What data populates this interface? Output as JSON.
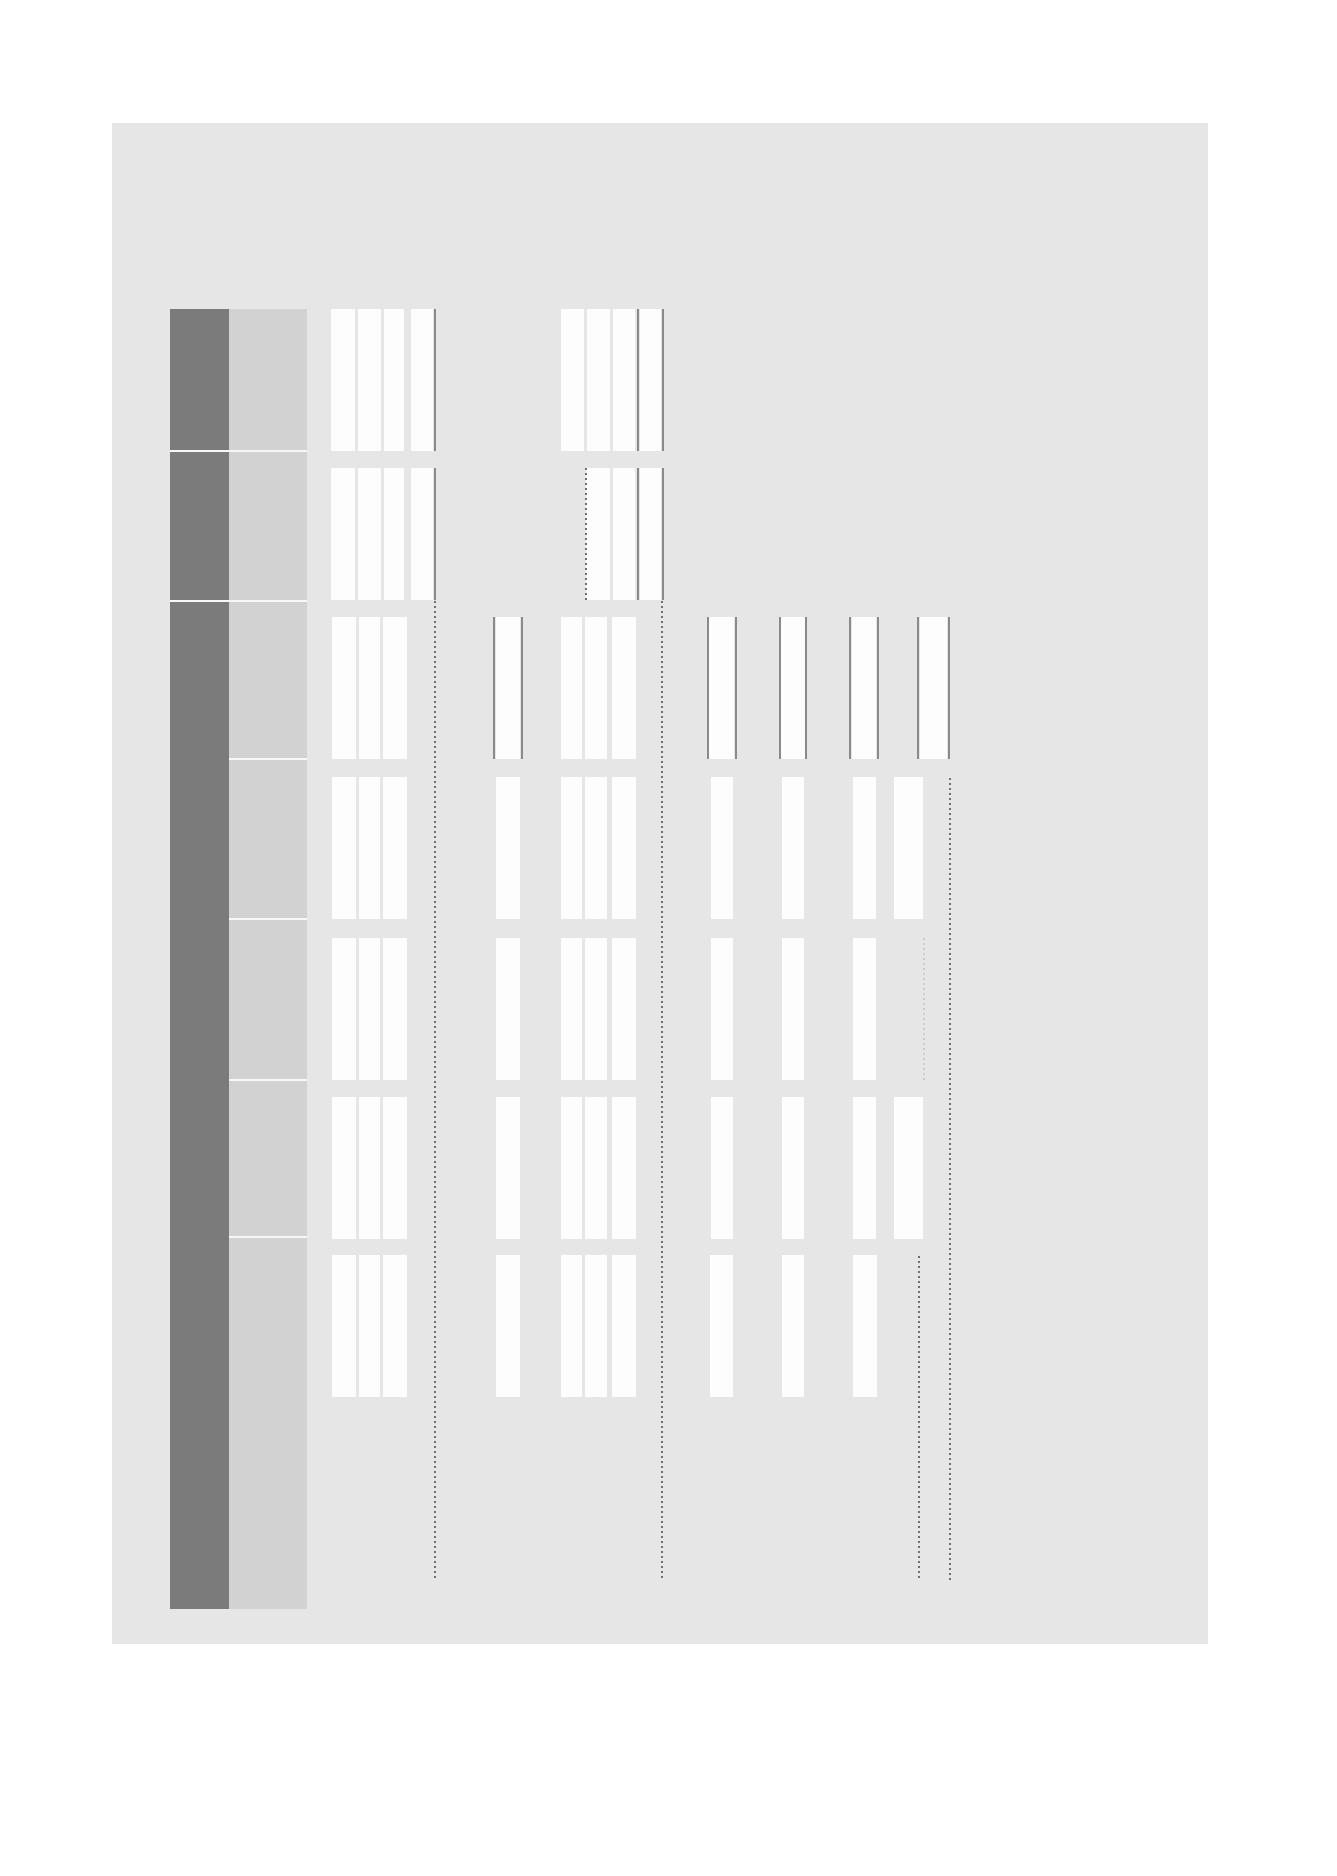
{
  "colors": {
    "canvas_bg": "#ffffff",
    "page_bg": "#e6e6e6",
    "header_dark": "#7b7b7b",
    "header_light": "#d2d2d2",
    "bar": "#fdfdfd",
    "border_line": "#8a8a8a",
    "dotted_dark": "#707070",
    "dotted_light": "#cccccc",
    "row_separator": "#f7f7f7"
  },
  "figure": {
    "canvas": {
      "w": 1337,
      "h": 1876
    },
    "page": {
      "x": 112,
      "y": 123,
      "w": 1096,
      "h": 1521
    },
    "header_columns": [
      {
        "id": "dark",
        "x": 170,
        "w": 59,
        "y": 309,
        "h": 1300,
        "color_key": "header_dark",
        "separators_y": [
          451,
          601
        ]
      },
      {
        "id": "light",
        "x": 229,
        "w": 78,
        "y": 309,
        "h": 1300,
        "color_key": "header_light",
        "separators_y": [
          451,
          601,
          759,
          919,
          1080,
          1237
        ]
      }
    ],
    "rows": [
      {
        "top": 309,
        "bottom": 451,
        "bars": [
          [
            331,
            24
          ],
          [
            358,
            23
          ],
          [
            384,
            20
          ],
          [
            411,
            22
          ],
          [
            561,
            23
          ],
          [
            587,
            23
          ],
          [
            613,
            22
          ],
          [
            640,
            21
          ]
        ],
        "lines": [
          434,
          637,
          662
        ]
      },
      {
        "top": 468,
        "bottom": 600,
        "bars": [
          [
            331,
            24
          ],
          [
            358,
            23
          ],
          [
            384,
            20
          ],
          [
            411,
            22
          ],
          [
            586,
            24
          ],
          [
            613,
            22
          ],
          [
            640,
            21
          ]
        ],
        "lines": [
          434,
          637,
          662
        ]
      },
      {
        "top": 617,
        "bottom": 759,
        "bars": [
          [
            332,
            24
          ],
          [
            359,
            21
          ],
          [
            383,
            24
          ],
          [
            496,
            24
          ],
          [
            561,
            21
          ],
          [
            585,
            22
          ],
          [
            612,
            24
          ],
          [
            709,
            25
          ],
          [
            781,
            24
          ],
          [
            852,
            24
          ],
          [
            920,
            27
          ]
        ],
        "lines": [
          493,
          521,
          707,
          735,
          779,
          805,
          849,
          877,
          917,
          948
        ]
      },
      {
        "top": 777,
        "bottom": 919,
        "bars": [
          [
            332,
            24
          ],
          [
            359,
            21
          ],
          [
            383,
            24
          ],
          [
            496,
            24
          ],
          [
            561,
            21
          ],
          [
            585,
            22
          ],
          [
            612,
            24
          ],
          [
            711,
            22
          ],
          [
            782,
            22
          ],
          [
            853,
            23
          ],
          [
            894,
            29
          ]
        ],
        "lines": []
      },
      {
        "top": 938,
        "bottom": 1080,
        "bars": [
          [
            332,
            24
          ],
          [
            359,
            21
          ],
          [
            383,
            24
          ],
          [
            496,
            24
          ],
          [
            561,
            21
          ],
          [
            585,
            22
          ],
          [
            612,
            24
          ],
          [
            711,
            22
          ],
          [
            782,
            22
          ],
          [
            853,
            23
          ]
        ],
        "lines": []
      },
      {
        "top": 1097,
        "bottom": 1239,
        "bars": [
          [
            332,
            24
          ],
          [
            359,
            21
          ],
          [
            383,
            24
          ],
          [
            496,
            24
          ],
          [
            561,
            21
          ],
          [
            585,
            22
          ],
          [
            612,
            24
          ],
          [
            711,
            22
          ],
          [
            782,
            22
          ],
          [
            853,
            23
          ],
          [
            894,
            29
          ]
        ],
        "lines": []
      },
      {
        "top": 1255,
        "bottom": 1397,
        "bars": [
          [
            332,
            24
          ],
          [
            359,
            21
          ],
          [
            383,
            24
          ],
          [
            496,
            24
          ],
          [
            561,
            21
          ],
          [
            585,
            22
          ],
          [
            612,
            24
          ],
          [
            710,
            23
          ],
          [
            782,
            22
          ],
          [
            853,
            24
          ]
        ],
        "lines": []
      }
    ],
    "dotted_lines": [
      {
        "x": 434,
        "y1": 601,
        "y2": 1580,
        "tone": "dark"
      },
      {
        "x": 585,
        "y1": 468,
        "y2": 600,
        "tone": "dark"
      },
      {
        "x": 661,
        "y1": 601,
        "y2": 1580,
        "tone": "dark"
      },
      {
        "x": 918,
        "y1": 1256,
        "y2": 1580,
        "tone": "dark"
      },
      {
        "x": 949,
        "y1": 778,
        "y2": 1580,
        "tone": "dark"
      },
      {
        "x": 923,
        "y1": 938,
        "y2": 1080,
        "tone": "light"
      }
    ]
  }
}
